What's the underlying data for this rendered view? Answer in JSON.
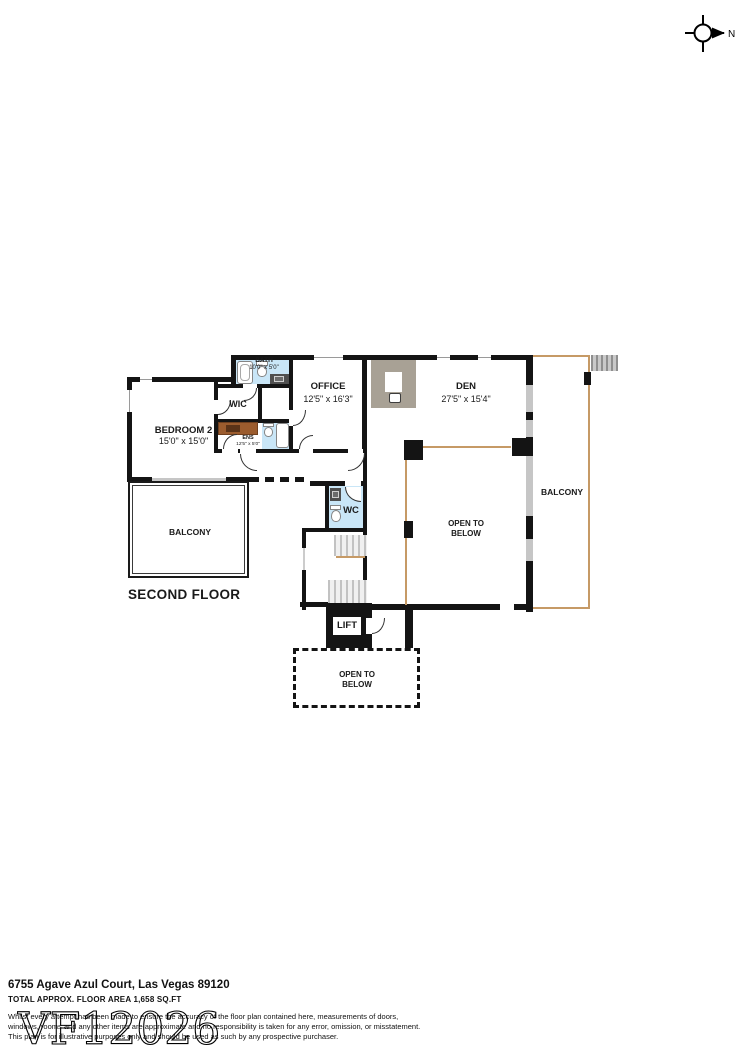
{
  "compass": {
    "label": "N"
  },
  "plan": {
    "floor_title": "SECOND FLOOR",
    "rooms": {
      "bedroom2": {
        "name": "BEDROOM 2",
        "dims": "15'0\" x 15'0\""
      },
      "wic": {
        "name": "WIC"
      },
      "bath": {
        "name": "BATH",
        "dims": "10'0\" x 5'0\""
      },
      "ens": {
        "name": "ENS",
        "dims": "12'5\" x 5'0\""
      },
      "office": {
        "name": "OFFICE",
        "dims": "12'5\" x 16'3\""
      },
      "den": {
        "name": "DEN",
        "dims": "27'5\" x 15'4\""
      },
      "wc": {
        "name": "WC"
      },
      "lift": {
        "name": "LIFT"
      },
      "balcony_left": {
        "name": "BALCONY"
      },
      "balcony_right": {
        "name": "BALCONY"
      },
      "open_below_main": {
        "line1": "OPEN TO",
        "line2": "BELOW"
      },
      "open_below_bottom": {
        "line1": "OPEN TO",
        "line2": "BELOW"
      }
    }
  },
  "footer": {
    "address": "6755 Agave Azul Court, Las Vegas 89120",
    "area": "TOTAL APPROX. FLOOR AREA 1,658 SQ.FT",
    "disclaimer_line1": "Whilst every attempt has been made to ensure the accuracy of the floor plan contained here, measurements of doors,",
    "disclaimer_line2": "windows, rooms and any other items are approximate and no responsibility is taken for any error, omission, or misstatement.",
    "disclaimer_line3": "This plan is for illustrative purposes only and should be used as such by any prospective purchaser.",
    "watermark": "VF12026"
  },
  "colors": {
    "wall": "#141414",
    "bathroom_fill": "#c9e6f7",
    "vanity_brown": "#9b5c2e",
    "counter_taupe": "#a8a195",
    "balcony_line_tan": "#c69a66"
  }
}
